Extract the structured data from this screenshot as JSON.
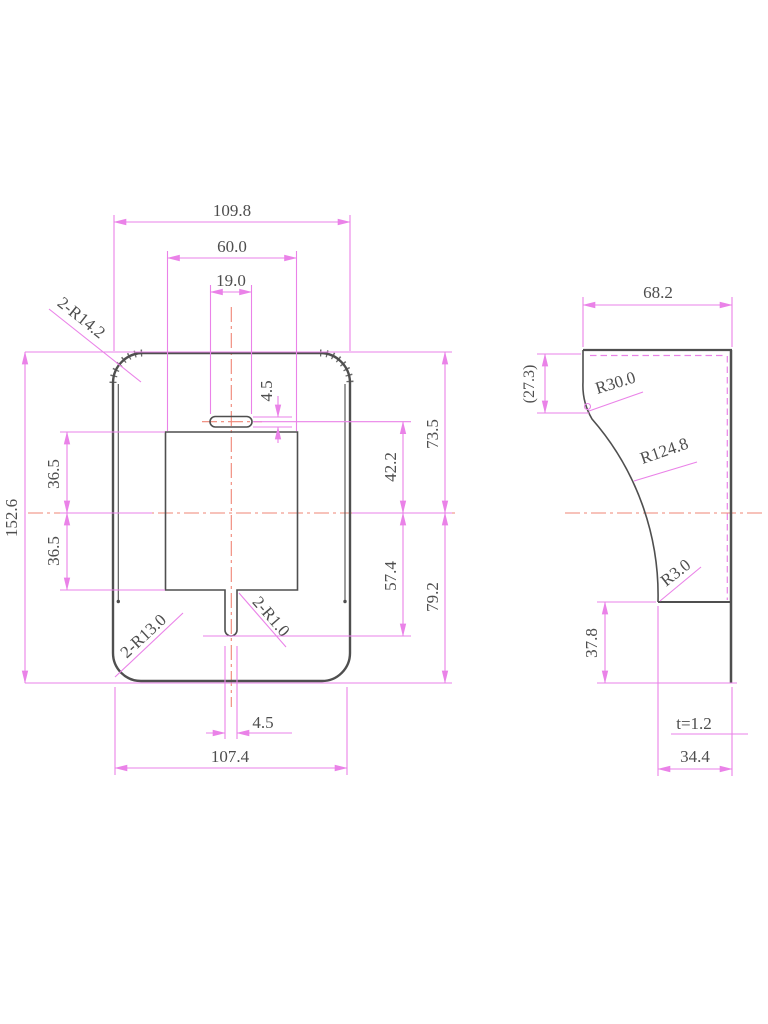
{
  "drawing_type": "engineering-dimension-drawing",
  "colors": {
    "dimension_lines": "#ea82e8",
    "part_outline": "#4f4f4f",
    "centerline": "#ef8576",
    "label_text": "#4e4e4e",
    "background": "#ffffff"
  },
  "front_view": {
    "width_top": "109.8",
    "hole_width": "60.0",
    "slot_top_length": "19.0",
    "slot_top_width": "4.5",
    "corner_radius_top": "2-R14.2",
    "height": "152.6",
    "hole_upper_half": "36.5",
    "hole_lower_half": "36.5",
    "slot_center_to_axis": "42.2",
    "axis_to_slot_bottom": "57.4",
    "top_to_axis": "73.5",
    "axis_to_bottom": "79.2",
    "corner_radius_bottom": "2-R13.0",
    "slot_corner_radius": "2-R1.0",
    "slot_bottom_width": "4.5",
    "width_bottom": "107.4"
  },
  "side_view": {
    "width": "68.2",
    "top_flat_height": "(27.3)",
    "radius_top": "R30.0",
    "radius_main": "R124.8",
    "radius_bottom": "R3.0",
    "lower_flange_height": "37.8",
    "sheet_thickness": "t=1.2",
    "bottom_width": "34.4"
  }
}
